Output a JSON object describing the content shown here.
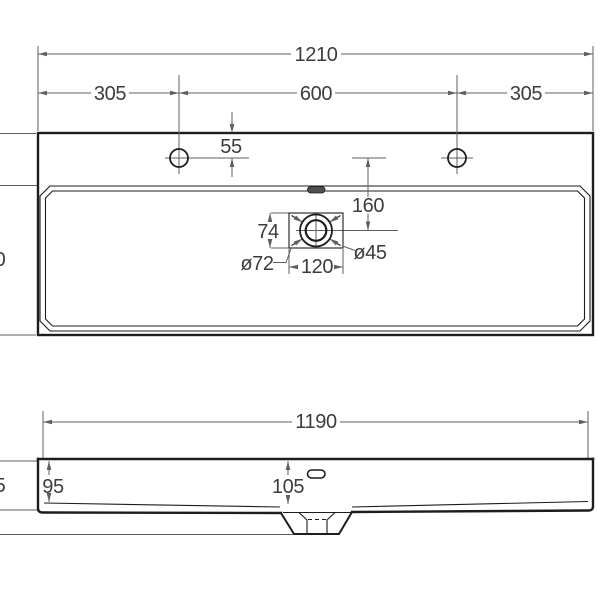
{
  "top_view": {
    "total_width": "1210",
    "left_hole_offset": "305",
    "holes_spacing": "600",
    "right_hole_offset": "305",
    "hole_edge_distance": "55",
    "drain_axis_distance": "160",
    "drain_box_height": "74",
    "drain_outer_diameter": "ø72",
    "drain_box_width": "120",
    "drain_inner_diameter": "ø45",
    "clipped_left_digit": "0"
  },
  "front_view": {
    "width": "1190",
    "side_height": "95",
    "center_height": "105",
    "clipped_left_digit": "5"
  },
  "colors": {
    "object_line": "#1d1d1d",
    "dimension_line": "#5f5f5f",
    "text": "#3c3c3c",
    "background": "#ffffff",
    "overflow_fill": "#4f4f4f"
  }
}
